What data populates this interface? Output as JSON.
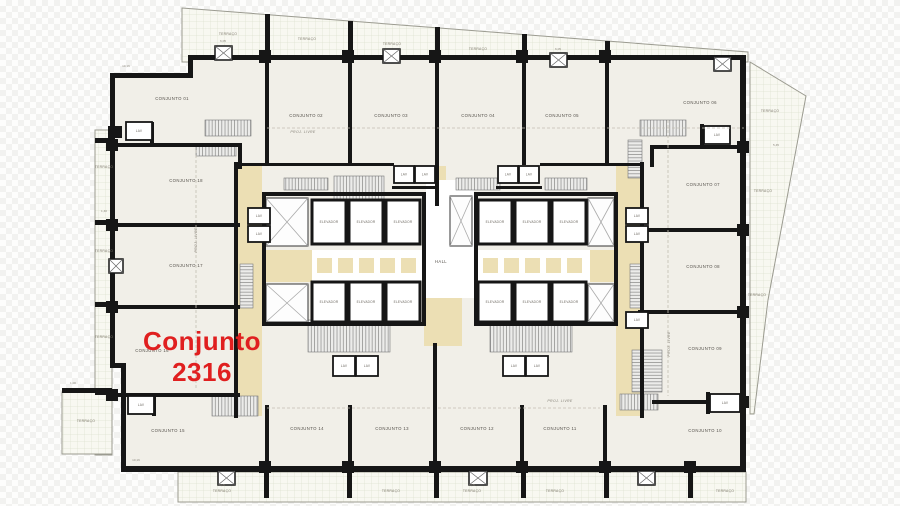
{
  "highlight": {
    "line1": "Conjunto",
    "line2": "2316",
    "color": "#e01f1f"
  },
  "labels": {
    "hall": "HALL",
    "elevator": "ELEVADOR",
    "lav": "LAV",
    "terrace": "TERRAÇO",
    "proj_livre": "PROJ. LIVRE"
  },
  "palette": {
    "wall": "#161616",
    "room_fill": "#f1efe8",
    "terrace_fill": "#f8f8f1",
    "terrace_grid": "#dde0cf",
    "terrace_edge": "#9b9b90",
    "corridor": "#ecdfb4",
    "white": "#ffffff",
    "hatch_line": "#8a8a8a",
    "hatch_bg": "#ececea",
    "shaft_line": "#aaaaaa",
    "dash": "#c2beb2"
  },
  "rooms": [
    {
      "label": "CONJUNTO 01",
      "x": 172,
      "y": 100
    },
    {
      "label": "CONJUNTO 02",
      "x": 306,
      "y": 117
    },
    {
      "label": "CONJUNTO 03",
      "x": 391,
      "y": 117
    },
    {
      "label": "CONJUNTO 04",
      "x": 478,
      "y": 117
    },
    {
      "label": "CONJUNTO 05",
      "x": 562,
      "y": 117
    },
    {
      "label": "CONJUNTO 06",
      "x": 700,
      "y": 104
    },
    {
      "label": "CONJUNTO 07",
      "x": 703,
      "y": 186
    },
    {
      "label": "CONJUNTO 08",
      "x": 703,
      "y": 268
    },
    {
      "label": "CONJUNTO 09",
      "x": 705,
      "y": 350
    },
    {
      "label": "CONJUNTO 10",
      "x": 705,
      "y": 432
    },
    {
      "label": "CONJUNTO 11",
      "x": 560,
      "y": 430
    },
    {
      "label": "CONJUNTO 12",
      "x": 477,
      "y": 430
    },
    {
      "label": "CONJUNTO 13",
      "x": 392,
      "y": 430
    },
    {
      "label": "CONJUNTO 14",
      "x": 307,
      "y": 430
    },
    {
      "label": "CONJUNTO 15",
      "x": 168,
      "y": 432
    },
    {
      "label": "CONJUNTO 16",
      "x": 152,
      "y": 352
    },
    {
      "label": "CONJUNTO 17",
      "x": 186,
      "y": 267
    },
    {
      "label": "CONJUNTO 18",
      "x": 186,
      "y": 182
    }
  ],
  "terrace_labels": [
    [
      228,
      35
    ],
    [
      307,
      40
    ],
    [
      392,
      45
    ],
    [
      478,
      50
    ],
    [
      770,
      112
    ],
    [
      763,
      192
    ],
    [
      757,
      296
    ],
    [
      104,
      168
    ],
    [
      104,
      252
    ],
    [
      104,
      338
    ],
    [
      86,
      422
    ],
    [
      222,
      492
    ],
    [
      391,
      492
    ],
    [
      472,
      492
    ],
    [
      555,
      492
    ],
    [
      725,
      492
    ]
  ],
  "proj_labels": [
    [
      303,
      133,
      0
    ],
    [
      197,
      240,
      -90
    ],
    [
      670,
      344,
      -90
    ],
    [
      560,
      402,
      0
    ]
  ],
  "dims": [
    [
      "10,16",
      126,
      67
    ],
    [
      "10,16",
      136,
      461
    ],
    [
      "6,05",
      223,
      42
    ],
    [
      "6,05",
      558,
      50
    ],
    [
      "6,05",
      222,
      486
    ],
    [
      "6,05",
      472,
      486
    ],
    [
      "1,00",
      73,
      384
    ],
    [
      "1,40",
      104,
      212
    ],
    [
      "5,45",
      776,
      146
    ]
  ],
  "hall_pos": [
    441,
    263
  ],
  "plan": {
    "main_poly": [
      [
        188,
        58
      ],
      [
        745,
        58
      ],
      [
        745,
        470
      ],
      [
        121,
        470
      ],
      [
        121,
        368
      ],
      [
        112,
        368
      ],
      [
        112,
        75
      ],
      [
        188,
        75
      ]
    ],
    "terraces": [
      [
        [
          182,
          8
        ],
        [
          748,
          52
        ],
        [
          748,
          62
        ],
        [
          182,
          62
        ]
      ],
      [
        [
          750,
          62
        ],
        [
          806,
          96
        ],
        [
          768,
          300
        ],
        [
          754,
          414
        ],
        [
          750,
          414
        ]
      ],
      [
        [
          95,
          130
        ],
        [
          112,
          130
        ],
        [
          112,
          455
        ],
        [
          95,
          455
        ]
      ],
      [
        [
          62,
          392
        ],
        [
          112,
          392
        ],
        [
          112,
          454
        ],
        [
          62,
          454
        ]
      ],
      [
        [
          178,
          472
        ],
        [
          746,
          472
        ],
        [
          746,
          502
        ],
        [
          178,
          502
        ]
      ]
    ],
    "corridors": [
      [
        238,
        166,
        24,
        250
      ],
      [
        616,
        166,
        24,
        250
      ],
      [
        428,
        166,
        18,
        80
      ],
      [
        424,
        298,
        38,
        48
      ],
      [
        266,
        250,
        46,
        32
      ],
      [
        590,
        250,
        28,
        32
      ]
    ],
    "whites": [
      [
        312,
        250,
        112,
        32
      ],
      [
        478,
        250,
        112,
        32
      ],
      [
        426,
        180,
        48,
        118
      ]
    ],
    "squares": [
      {
        "x0": 316,
        "y": 257,
        "n": 5,
        "step": 21,
        "s": 17
      },
      {
        "x0": 482,
        "y": 257,
        "n": 5,
        "step": 21,
        "s": 17
      }
    ],
    "stairs_h": [
      [
        205,
        120,
        46,
        16
      ],
      [
        196,
        144,
        40,
        12
      ],
      [
        334,
        176,
        50,
        24
      ],
      [
        640,
        120,
        46,
        16
      ],
      [
        308,
        320,
        82,
        32
      ],
      [
        490,
        320,
        82,
        32
      ],
      [
        212,
        396,
        46,
        20
      ],
      [
        620,
        394,
        38,
        16
      ],
      [
        284,
        178,
        44,
        12
      ],
      [
        456,
        178,
        44,
        12
      ],
      [
        545,
        178,
        42,
        12
      ]
    ],
    "stairs_v": [
      [
        628,
        140,
        14,
        38
      ],
      [
        240,
        264,
        13,
        44
      ],
      [
        630,
        264,
        13,
        44
      ],
      [
        632,
        350,
        30,
        42
      ]
    ],
    "shafts": [
      [
        266,
        198,
        42,
        48
      ],
      [
        266,
        284,
        42,
        38
      ],
      [
        588,
        198,
        26,
        48
      ],
      [
        588,
        284,
        26,
        38
      ],
      [
        450,
        196,
        22,
        50
      ]
    ],
    "cells": [
      [
        312,
        200,
        34,
        44
      ],
      [
        349,
        200,
        34,
        44
      ],
      [
        386,
        200,
        34,
        44
      ],
      [
        312,
        282,
        34,
        40
      ],
      [
        349,
        282,
        34,
        40
      ],
      [
        386,
        282,
        34,
        40
      ],
      [
        478,
        200,
        34,
        44
      ],
      [
        515,
        200,
        34,
        44
      ],
      [
        552,
        200,
        34,
        44
      ],
      [
        478,
        282,
        34,
        40
      ],
      [
        515,
        282,
        34,
        40
      ],
      [
        552,
        282,
        34,
        40
      ]
    ],
    "lavs": [
      [
        126,
        122,
        26,
        18
      ],
      [
        128,
        396,
        26,
        18
      ],
      [
        704,
        126,
        26,
        18
      ],
      [
        710,
        394,
        30,
        18
      ],
      [
        394,
        166,
        20,
        17
      ],
      [
        415,
        166,
        20,
        17
      ],
      [
        498,
        166,
        20,
        17
      ],
      [
        519,
        166,
        20,
        17
      ],
      [
        248,
        208,
        22,
        16
      ],
      [
        248,
        226,
        22,
        16
      ],
      [
        626,
        208,
        22,
        16
      ],
      [
        626,
        226,
        22,
        16
      ],
      [
        626,
        312,
        22,
        16
      ],
      [
        333,
        356,
        22,
        20
      ],
      [
        356,
        356,
        22,
        20
      ],
      [
        503,
        356,
        22,
        20
      ],
      [
        526,
        356,
        22,
        20
      ]
    ],
    "walls": [
      [
        188,
        55,
        558,
        5
      ],
      [
        110,
        73,
        82,
        5
      ],
      [
        188,
        55,
        5,
        23
      ],
      [
        110,
        73,
        5,
        295
      ],
      [
        110,
        363,
        16,
        5
      ],
      [
        121,
        363,
        5,
        105
      ],
      [
        121,
        466,
        625,
        6
      ],
      [
        740,
        57,
        6,
        415
      ],
      [
        265,
        58,
        4,
        107
      ],
      [
        348,
        58,
        4,
        107
      ],
      [
        435,
        58,
        4,
        148
      ],
      [
        522,
        58,
        4,
        107
      ],
      [
        605,
        58,
        4,
        107
      ],
      [
        265,
        405,
        4,
        63
      ],
      [
        348,
        405,
        4,
        63
      ],
      [
        433,
        343,
        4,
        125
      ],
      [
        520,
        405,
        4,
        63
      ],
      [
        603,
        405,
        4,
        63
      ],
      [
        112,
        143,
        130,
        4
      ],
      [
        112,
        223,
        128,
        4
      ],
      [
        112,
        305,
        128,
        4
      ],
      [
        112,
        393,
        128,
        4
      ],
      [
        238,
        143,
        4,
        26
      ],
      [
        650,
        145,
        4,
        22
      ],
      [
        652,
        145,
        92,
        4
      ],
      [
        638,
        228,
        106,
        4
      ],
      [
        638,
        310,
        106,
        4
      ],
      [
        652,
        400,
        92,
        4
      ],
      [
        262,
        192,
        164,
        4
      ],
      [
        262,
        192,
        4,
        134
      ],
      [
        262,
        322,
        164,
        4
      ],
      [
        422,
        192,
        4,
        134
      ],
      [
        474,
        192,
        144,
        4
      ],
      [
        474,
        192,
        4,
        134
      ],
      [
        474,
        322,
        144,
        4
      ],
      [
        614,
        192,
        4,
        134
      ],
      [
        234,
        162,
        4,
        256
      ],
      [
        640,
        162,
        4,
        256
      ],
      [
        234,
        163,
        160,
        3
      ],
      [
        540,
        163,
        104,
        3
      ],
      [
        392,
        186,
        46,
        3
      ],
      [
        496,
        186,
        46,
        3
      ],
      [
        150,
        122,
        4,
        24
      ],
      [
        152,
        394,
        4,
        22
      ],
      [
        700,
        124,
        4,
        22
      ],
      [
        706,
        392,
        4,
        22
      ]
    ],
    "piers": [
      [
        259,
        50,
        12,
        13
      ],
      [
        342,
        50,
        12,
        13
      ],
      [
        429,
        50,
        12,
        13
      ],
      [
        516,
        50,
        12,
        13
      ],
      [
        599,
        50,
        12,
        13
      ],
      [
        259,
        461,
        12,
        12
      ],
      [
        342,
        461,
        12,
        12
      ],
      [
        429,
        461,
        12,
        12
      ],
      [
        516,
        461,
        12,
        12
      ],
      [
        599,
        461,
        12,
        12
      ],
      [
        684,
        461,
        12,
        12
      ],
      [
        106,
        139,
        12,
        12
      ],
      [
        106,
        219,
        12,
        12
      ],
      [
        106,
        301,
        12,
        12
      ],
      [
        106,
        389,
        12,
        12
      ],
      [
        737,
        141,
        12,
        12
      ],
      [
        737,
        224,
        12,
        12
      ],
      [
        737,
        306,
        12,
        12
      ],
      [
        737,
        396,
        12,
        12
      ]
    ],
    "stubs": [
      [
        265,
        14,
        5,
        44
      ],
      [
        348,
        21,
        5,
        37
      ],
      [
        435,
        27,
        5,
        31
      ],
      [
        522,
        34,
        5,
        24
      ],
      [
        605,
        41,
        5,
        17
      ],
      [
        264,
        472,
        5,
        26
      ],
      [
        347,
        472,
        5,
        26
      ],
      [
        434,
        472,
        5,
        26
      ],
      [
        521,
        472,
        5,
        26
      ],
      [
        604,
        472,
        5,
        26
      ],
      [
        688,
        472,
        5,
        26
      ],
      [
        95,
        138,
        16,
        5
      ],
      [
        95,
        220,
        16,
        5
      ],
      [
        95,
        302,
        16,
        5
      ],
      [
        95,
        390,
        16,
        5
      ],
      [
        108,
        126,
        14,
        12
      ],
      [
        62,
        388,
        50,
        5
      ]
    ],
    "xboxes": [
      [
        215,
        46,
        17,
        14
      ],
      [
        383,
        49,
        17,
        14
      ],
      [
        550,
        53,
        17,
        14
      ],
      [
        714,
        57,
        17,
        14
      ],
      [
        218,
        471,
        17,
        14
      ],
      [
        469,
        471,
        18,
        14
      ],
      [
        638,
        471,
        17,
        14
      ],
      [
        109,
        259,
        14,
        14
      ]
    ],
    "dashed": [
      [
        267,
        128,
        744,
        128
      ],
      [
        196,
        150,
        196,
        388
      ],
      [
        267,
        408,
        430,
        408
      ],
      [
        438,
        408,
        600,
        408
      ],
      [
        668,
        120,
        668,
        396
      ]
    ]
  }
}
